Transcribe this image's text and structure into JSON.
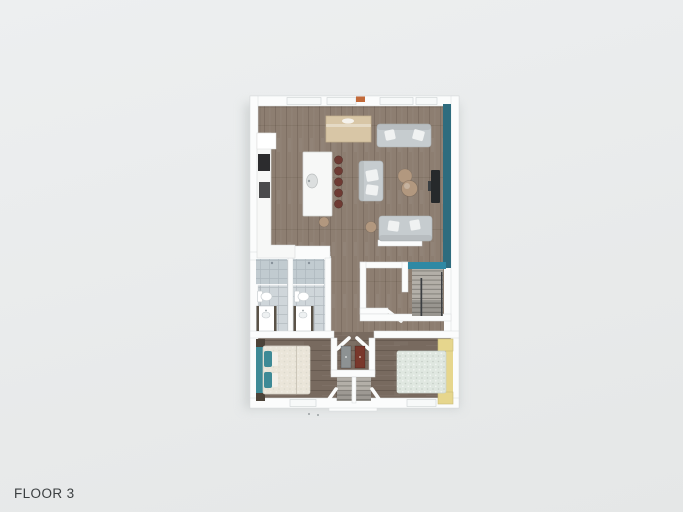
{
  "floor_label": "FLOOR 3",
  "colors": {
    "bg_top": "#edeff0",
    "bg_bottom": "#e5e7e7",
    "label": "#3b3f41",
    "wall": "#fbfcfc",
    "wall_edge": "#d7dadb",
    "shadow": "#ccd0d0",
    "wood_living": "#8d7e71",
    "wood_bedroom": "#786a5f",
    "tile": "#cfd6da",
    "shower_tint": "#9fb0b8",
    "teal_wall": "#2e6c7e",
    "teal_stair": "#2f89a4",
    "counter": "#f7f8f7",
    "appliance": "#2c2c2e",
    "stool": "#6e3a33",
    "table_beige": "#d8c6a6",
    "sofa": "#c6cccf",
    "cushion": "#f0f2f2",
    "pouf": "#b2987f",
    "tv": "#26292b",
    "bed_duvet": "#eae5d9",
    "bed_duvet2": "#dfe7e0",
    "bed_teal": "#3e8a96",
    "bed_yellow": "#e6d68d",
    "nightstand": "#4c4339",
    "cabinet_gray": "#8d9293",
    "cabinet_maroon": "#79382c",
    "stair_tread": "#b3afa8",
    "railing": "#3b3e41",
    "vent_orange": "#c26a3a",
    "fixture_edge": "#c9cfd2"
  }
}
